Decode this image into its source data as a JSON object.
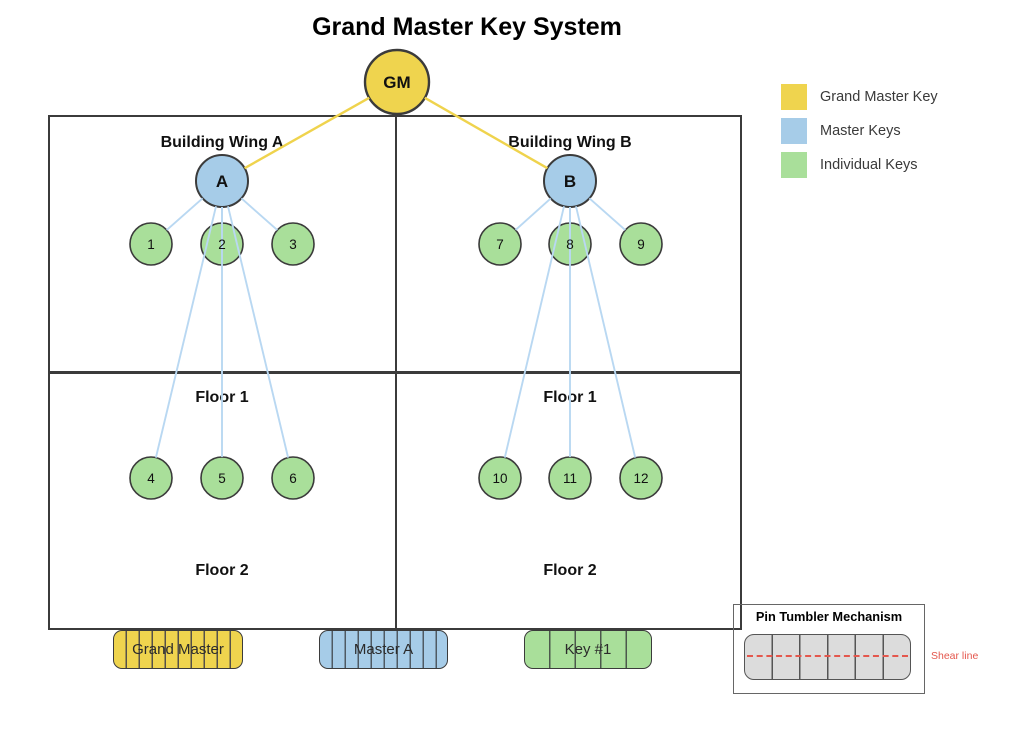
{
  "title": "Grand Master Key System",
  "legend": {
    "items": [
      {
        "label": "Grand Master Key",
        "color": "#efd44e"
      },
      {
        "label": "Master Keys",
        "color": "#a6cce8"
      },
      {
        "label": "Individual Keys",
        "color": "#a9df9a"
      }
    ]
  },
  "sections": {
    "wing_a": "Building Wing A",
    "wing_b": "Building Wing B",
    "floor1_left": "Floor 1",
    "floor1_right": "Floor 1",
    "floor2_left": "Floor 2",
    "floor2_right": "Floor 2"
  },
  "nodes": {
    "gm": "GM",
    "a": "A",
    "b": "B",
    "leaves": [
      "1",
      "2",
      "3",
      "4",
      "5",
      "6",
      "7",
      "8",
      "9",
      "10",
      "11",
      "12"
    ]
  },
  "keys": [
    {
      "label": "Grand Master",
      "type": "grand-master",
      "color": "#efd44e"
    },
    {
      "label": "Master A",
      "type": "master",
      "color": "#a6cce8"
    },
    {
      "label": "Key #1",
      "type": "individual",
      "color": "#a9df9a"
    }
  ],
  "pin_tumbler": {
    "title": "Pin Tumbler Mechanism",
    "shear_label": "Shear line",
    "pin_count": 6,
    "shear_color": "#e4574d",
    "pin_fill": "#dcdcdc"
  },
  "colors": {
    "grand_master_fill": "#efd44e",
    "master_fill": "#a6cce8",
    "individual_fill": "#a9df9a",
    "edge_master": "#b9d8f2",
    "edge_grand": "#efd34d",
    "outline": "#3b3b3b"
  }
}
